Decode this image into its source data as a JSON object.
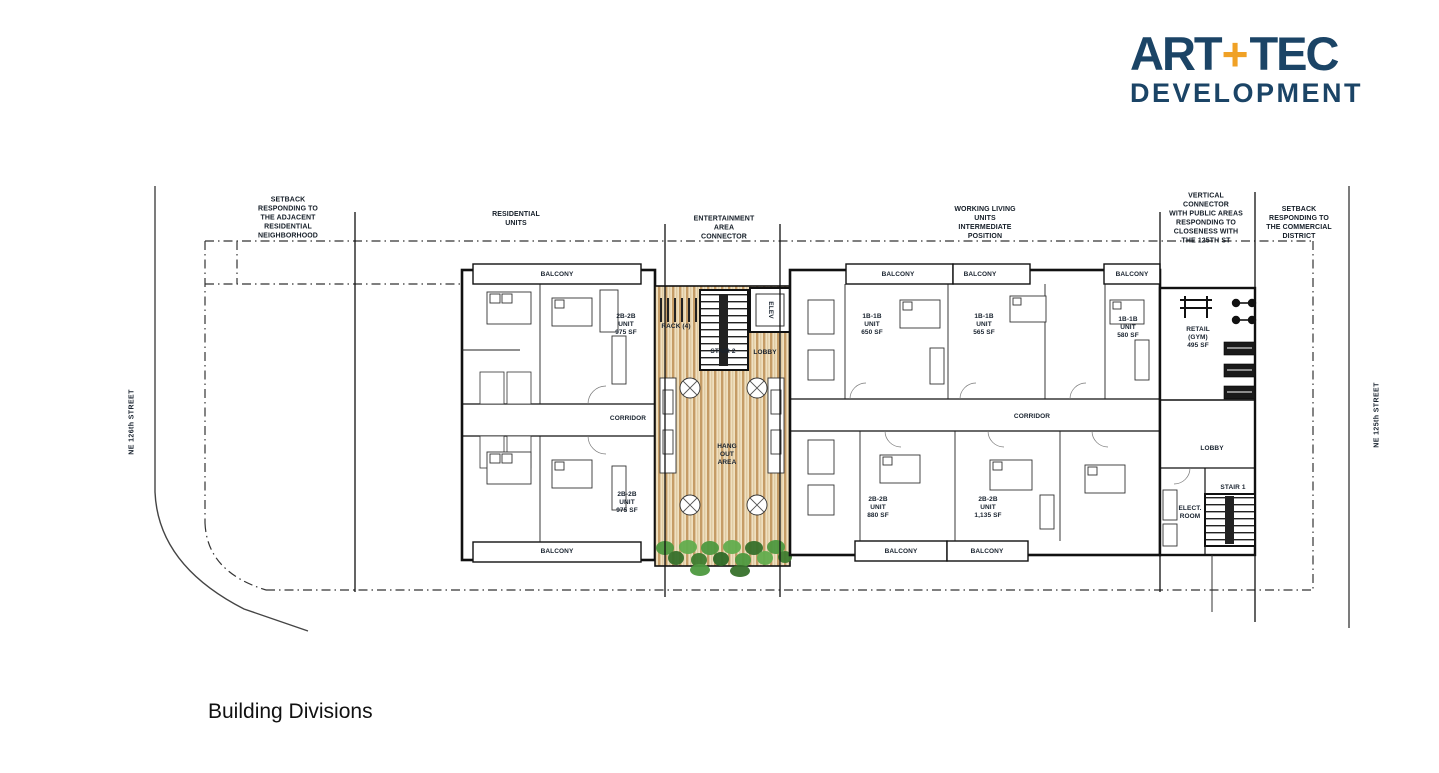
{
  "logo": {
    "word1": "ART",
    "plus": "+",
    "word2": "TEC",
    "word3": "DEVELOPMENT",
    "navy": "#1b4466",
    "orange": "#f0a125"
  },
  "caption": "Building Divisions",
  "streets": {
    "left": "NE 126th STREET",
    "right": "NE 125th STREET"
  },
  "zone_labels": {
    "setback_residential": "SETBACK\nRESPONDING TO\nTHE ADJACENT\nRESIDENTIAL\nNEIGHBORHOOD",
    "residential_units": "RESIDENTIAL\nUNITS",
    "entertainment_connector": "ENTERTAINMENT\nAREA\nCONNECTOR",
    "working_living": "WORKING LIVING\nUNITS\nINTERMEDIATE\nPOSITION",
    "vertical_connector": "VERTICAL\nCONNECTOR\nWITH PUBLIC AREAS\nRESPONDING TO\nCLOSENESS WITH\nTHE 125TH ST",
    "setback_commercial": "SETBACK\nRESPONDING TO\nTHE COMMERCIAL\nDISTRICT"
  },
  "plan": {
    "balcony": "BALCONY",
    "corridor": "CORRIDOR",
    "lobby": "LOBBY",
    "stair2": "STAIR 2",
    "stair1": "STAIR 1",
    "elev": "ELEV",
    "rack": "RACK (4)",
    "hang_out": "HANG\nOUT\nAREA",
    "elect_room": "ELECT.\nROOM",
    "retail_gym": "RETAIL\n(GYM)\n495 SF",
    "unit_2b2b_975_top": "2B-2B\nUNIT\n975 SF",
    "unit_2b2b_975_bottom": "2B-2B\nUNIT\n975 SF",
    "unit_1b1b_650": "1B-1B\nUNIT\n650 SF",
    "unit_1b1b_565": "1B-1B\nUNIT\n565 SF",
    "unit_1b1b_580": "1B-1B\nUNIT\n580 SF",
    "unit_2b2b_880": "2B-2B\nUNIT\n880 SF",
    "unit_2b2b_1135": "2B-2B\nUNIT\n1,135 SF"
  }
}
